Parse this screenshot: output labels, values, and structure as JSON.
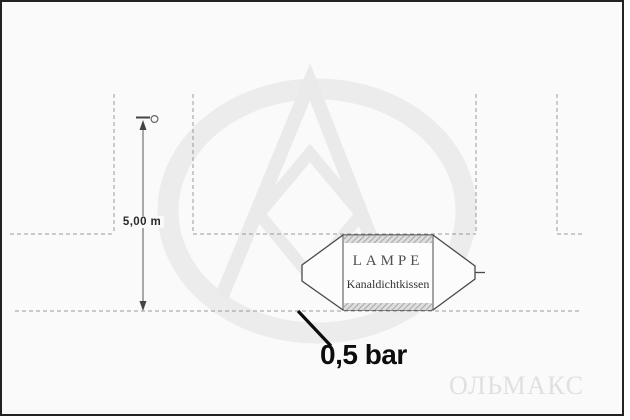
{
  "diagram": {
    "dimension_label": "5,00 m",
    "pressure_label": "0,5 bar",
    "cushion_brand": "LAMPE",
    "cushion_product": "Kanaldichtkissen",
    "watermark_text": "ОЛЬМАКС",
    "colors": {
      "canvas_background": "#fafafa",
      "frame_border": "#222222",
      "dashed_wall_line": "#999999",
      "cushion_outline": "#4a4a4a",
      "dimension_line": "#444444",
      "annotation_black": "#0d0d0d",
      "watermark_gray": "#eaeaea"
    }
  }
}
